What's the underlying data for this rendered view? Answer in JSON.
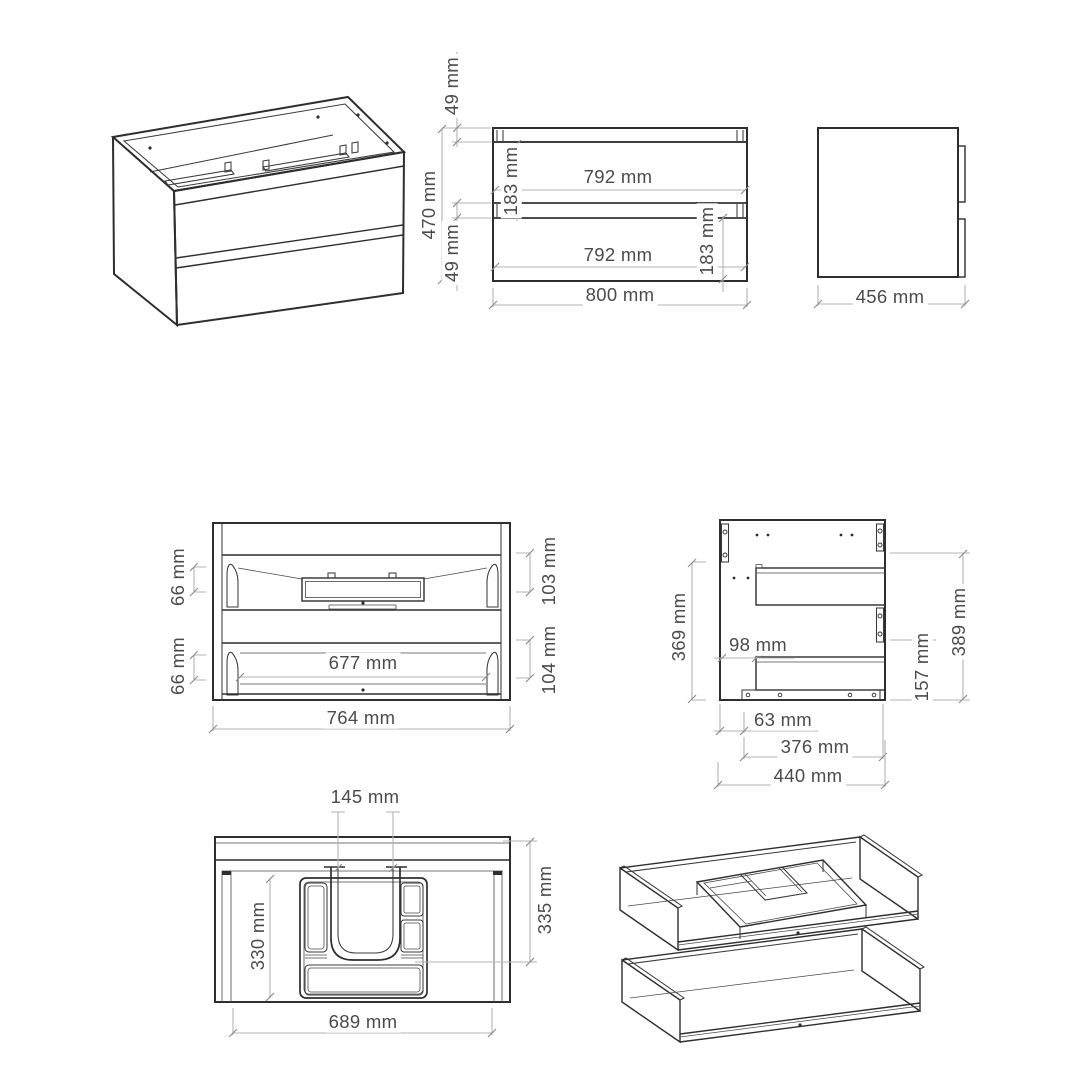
{
  "views": {
    "front_elevation": {
      "dims": {
        "top_rail": "49 mm",
        "overall_height": "470 mm",
        "middle_gap": "49 mm",
        "top_front_height": "183 mm",
        "top_front_width": "792 mm",
        "bottom_front_width": "792 mm",
        "bottom_front_height": "183 mm",
        "overall_width": "800 mm"
      }
    },
    "side_view": {
      "dims": {
        "overall_depth": "456 mm"
      }
    },
    "front_interior": {
      "dims": {
        "top_drawer_side_height": "66 mm",
        "bottom_drawer_side_height": "66 mm",
        "top_drawer_height": "103 mm",
        "bottom_drawer_height": "104 mm",
        "drawer_inner_width": "677 mm",
        "carcass_inner_width": "764 mm"
      }
    },
    "side_interior": {
      "dims": {
        "left_panel_height": "369 mm",
        "rail_setback": "98 mm",
        "right_panel_height": "389 mm",
        "lower_rail_height": "157 mm",
        "front_offset": "63 mm",
        "rail_length": "376 mm",
        "panel_depth": "440 mm"
      }
    },
    "top_view": {
      "dims": {
        "cutout_width": "145 mm",
        "inner_depth": "330 mm",
        "drawer_depth": "335 mm",
        "drawer_inner_width": "689 mm"
      }
    }
  },
  "colors": {
    "object_line": "#2e2e2e",
    "dimension_line": "#b3b3b3",
    "dimension_text": "#4b4b4b",
    "background": "#ffffff"
  }
}
